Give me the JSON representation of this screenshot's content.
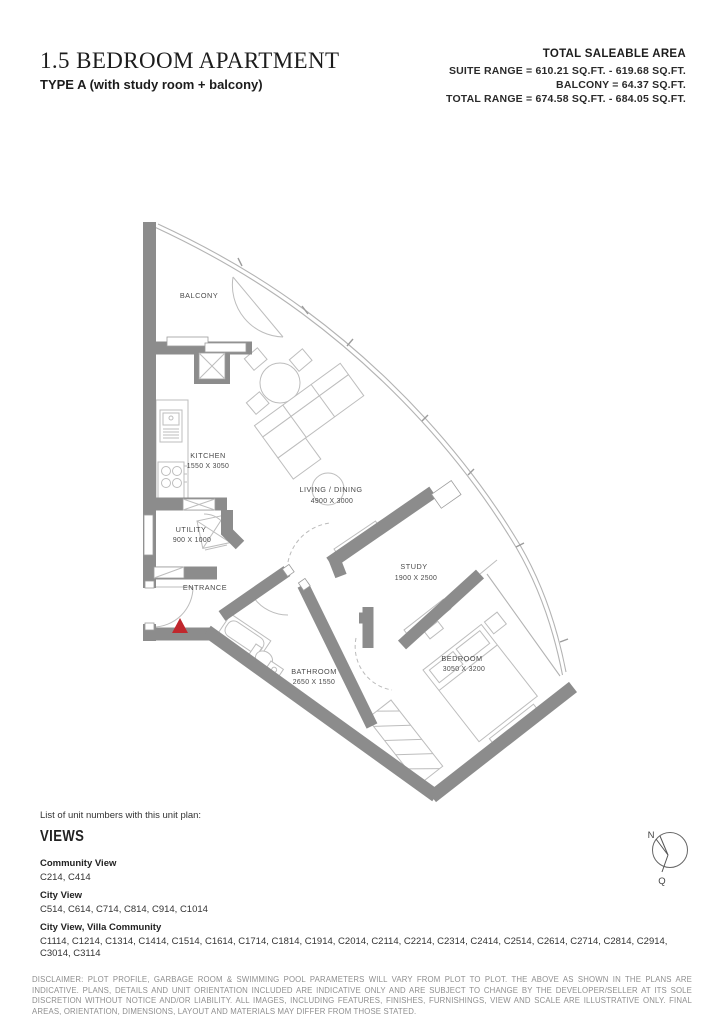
{
  "header": {
    "title": "1.5 BEDROOM APARTMENT",
    "subtitle": "TYPE A (with study room + balcony)",
    "area": {
      "heading": "TOTAL SALEABLE AREA",
      "lines": [
        "SUITE RANGE = 610.21 SQ.FT. - 619.68 SQ.FT.",
        "BALCONY = 64.37 SQ.FT.",
        "TOTAL RANGE = 674.58 SQ.FT. - 684.05 SQ.FT."
      ]
    }
  },
  "floorplan": {
    "rooms": [
      {
        "name": "BALCONY",
        "dims": ""
      },
      {
        "name": "KITCHEN",
        "dims": "1550 X 3050"
      },
      {
        "name": "LIVING / DINING",
        "dims": "4900 X 3000"
      },
      {
        "name": "UTILITY",
        "dims": "900 X 1000"
      },
      {
        "name": "ENTRANCE",
        "dims": ""
      },
      {
        "name": "STUDY",
        "dims": "1900 X 2500"
      },
      {
        "name": "BATHROOM",
        "dims": "2650 X 1550"
      },
      {
        "name": "BEDROOM",
        "dims": "3050 X 3200"
      }
    ],
    "colors": {
      "wall": "#8c8c8c",
      "furniture_line": "#bdbdbd",
      "facade_line": "#b3b3b3",
      "label_text": "#4a4a4a",
      "entrance_marker": "#c0272d"
    }
  },
  "compass": {
    "north_label": "N",
    "secondary_label": "Q"
  },
  "views": {
    "intro": "List of unit numbers with this unit plan:",
    "heading": "VIEWS",
    "groups": [
      {
        "label": "Community View",
        "units": "C214, C414"
      },
      {
        "label": "City View",
        "units": "C514, C614, C714, C814, C914, C1014"
      },
      {
        "label": "City View, Villa Community",
        "units": "C1114, C1214, C1314, C1414, C1514, C1614, C1714, C1814, C1914, C2014, C2114, C2214, C2314, C2414, C2514, C2614, C2714, C2814, C2914, C3014, C3114"
      }
    ]
  },
  "disclaimer": "DISCLAIMER: PLOT PROFILE, GARBAGE ROOM & SWIMMING POOL PARAMETERS WILL VARY FROM PLOT TO PLOT. THE ABOVE AS SHOWN IN THE PLANS ARE INDICATIVE. PLANS, DETAILS AND UNIT ORIENTATION INCLUDED ARE INDICATIVE ONLY AND ARE SUBJECT TO CHANGE BY THE DEVELOPER/SELLER AT ITS SOLE DISCRETION WITHOUT NOTICE AND/OR LIABILITY. ALL IMAGES, INCLUDING FEATURES, FINISHES, FURNISHINGS, VIEW AND SCALE ARE ILLUSTRATIVE ONLY. FINAL AREAS, ORIENTATION, DIMENSIONS, LAYOUT AND MATERIALS MAY DIFFER FROM THOSE STATED."
}
